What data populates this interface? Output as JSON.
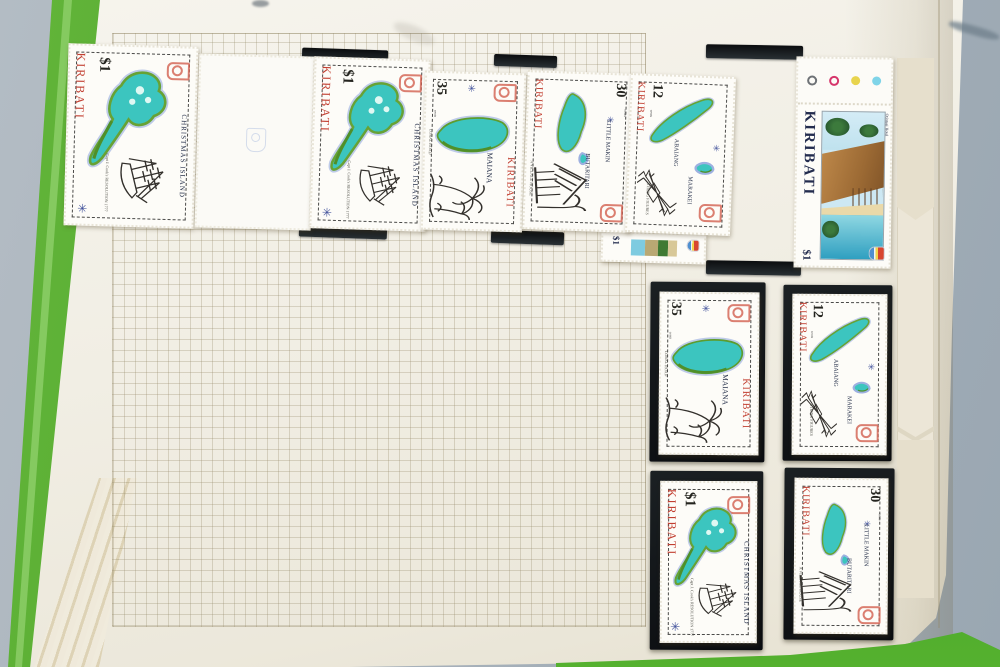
{
  "palette": {
    "background_grey": "#a8b2bb",
    "cover_green": "#53a92e",
    "page_cream": "#f1eee3",
    "grid_line": "#cdc6ad",
    "mount_black": "#121517",
    "stamp_red": "#c23f31",
    "lagoon_teal": "#3cc5bf",
    "land_green": "#67a235",
    "water_outline_blue": "#9db0e0",
    "navy_text": "#2c3750",
    "hotel_roof_brown": "#a9713d",
    "sea_blue": "#3fa8c8"
  },
  "icons": {
    "compass_star": "✳"
  },
  "registration_dots": [
    "#6e7276",
    "#d6356b",
    "#e8d44d",
    "#7fd4e8"
  ],
  "stamps": {
    "christmas_dollar": {
      "country": "KIRIBATI",
      "denomination": "$1",
      "island": "CHRISTMAS ISLAND",
      "caption": "Capt J. Cook's RESOLUTION 1777"
    },
    "maiana_35": {
      "country": "KIRIBATI",
      "denomination": "35",
      "unit": "cents",
      "island": "MAIANA",
      "caption": "CORAL ROAD"
    },
    "makin_30": {
      "country": "KIRIBATI",
      "denomination": "30",
      "unit": "cents",
      "island": "LITTLE MAKIN",
      "island2": "BUTARITARI",
      "caption": "A VILLAGE HOUSE"
    },
    "abaiang_12": {
      "country": "KIRIBATI",
      "denomination": "12",
      "unit": "cents",
      "island": "ABAIANG",
      "island2": "MARAKEI",
      "caption": "STRING FIGURES"
    },
    "hotel_dollar": {
      "country": "KIRIBATI",
      "denomination": "$1",
      "title": "Otintaai Hotel"
    },
    "partial_strip": {
      "denomination": "$1"
    }
  }
}
